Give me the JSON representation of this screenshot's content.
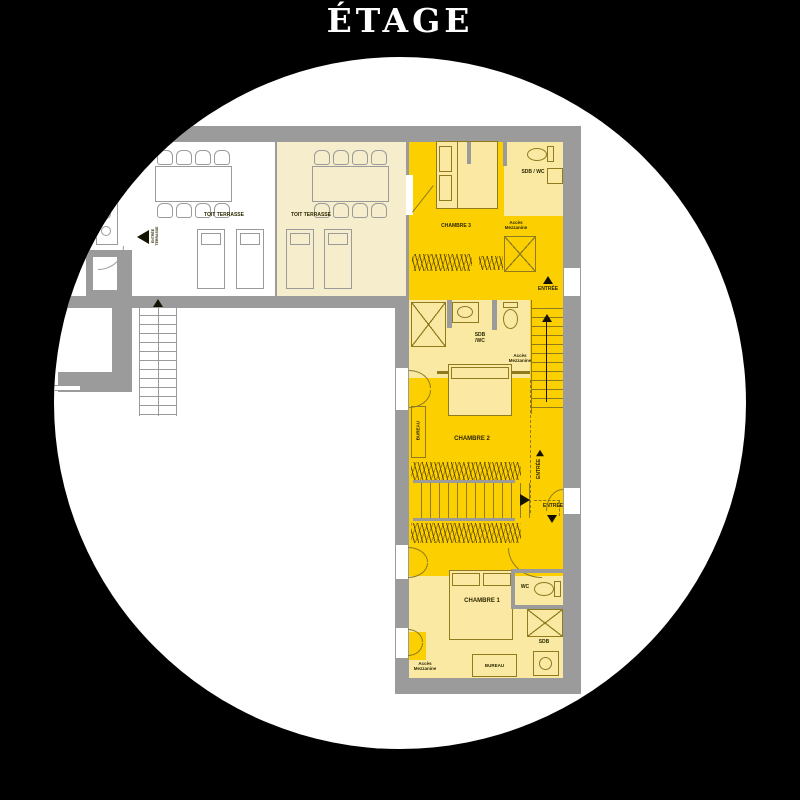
{
  "title": "ÉTAGE",
  "colors": {
    "background": "#000000",
    "canvas": "#ffffff",
    "wall": "#9b9b9b",
    "bright": "#fccf00",
    "light": "#f9e9a2",
    "cream": "#f5edcb",
    "line": "#8f7a1e",
    "text": "#2d2800"
  },
  "terrace_left": {
    "label": "TOIT TERRASSE"
  },
  "terrace_right": {
    "label": "TOIT TERRASSE"
  },
  "rooms": {
    "chambre1": "CHAMBRE 1",
    "chambre2": "CHAMBRE 2",
    "chambre3": "CHAMBRE 3",
    "sdb_wc_top": "SDB / WC",
    "sdb_mid_line1": "SDB",
    "sdb_mid_line2": "/WC",
    "wc": "WC",
    "sdb": "SDB"
  },
  "labels": {
    "entree": "ENTRÉE",
    "entree_terrasse_line1": "ENTRÉE",
    "entree_terrasse_line2": "TERRASSE",
    "acces_line1": "Accès",
    "acces_line2": "Mezzanine",
    "bureau": "BUREAU"
  }
}
